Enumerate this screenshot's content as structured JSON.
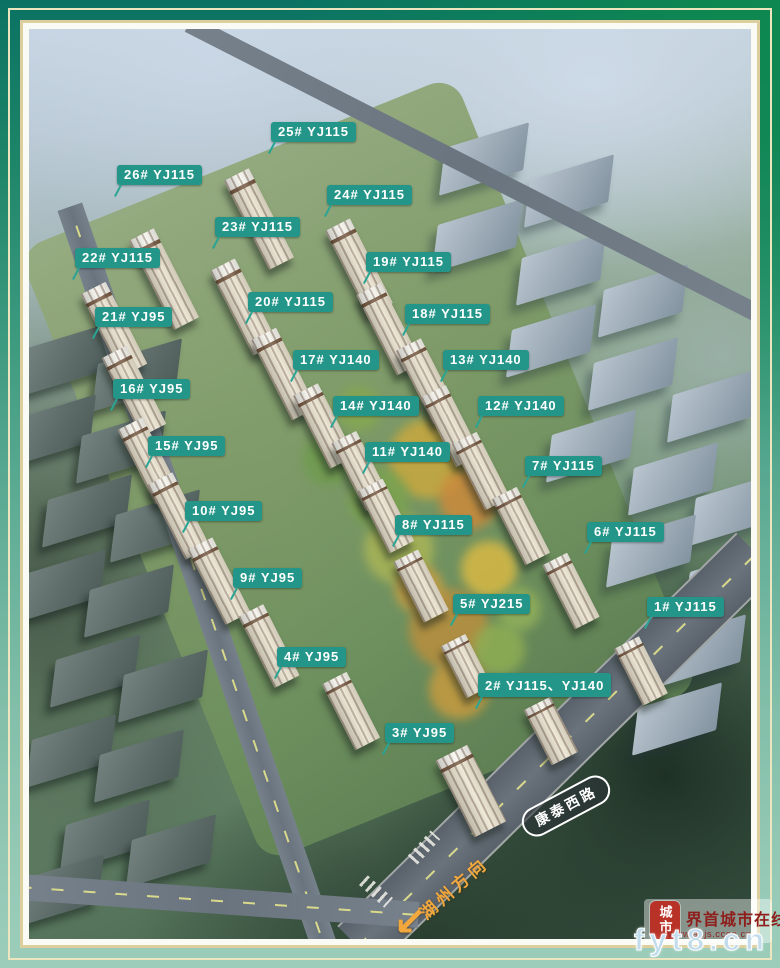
{
  "colors": {
    "label_bg": "#249689",
    "label_text": "#ffffff",
    "frame_teal_dark": "#0b7263",
    "frame_green": "#0e8a4e",
    "frame_teal_light": "#9ccdbb",
    "frame_line_cream": "#ece5bd",
    "direction_orange": "#f2a83c",
    "watermark_red": "#8e1f1c",
    "watermark_blue": "#c2dcec"
  },
  "site_labels": [
    {
      "text": "25# YJ115",
      "x": 242,
      "y": 93
    },
    {
      "text": "26# YJ115",
      "x": 88,
      "y": 136
    },
    {
      "text": "24# YJ115",
      "x": 298,
      "y": 156
    },
    {
      "text": "23# YJ115",
      "x": 186,
      "y": 188
    },
    {
      "text": "22# YJ115",
      "x": 46,
      "y": 219
    },
    {
      "text": "19# YJ115",
      "x": 337,
      "y": 223
    },
    {
      "text": "20# YJ115",
      "x": 219,
      "y": 263
    },
    {
      "text": "21# YJ95",
      "x": 66,
      "y": 278
    },
    {
      "text": "18# YJ115",
      "x": 376,
      "y": 275
    },
    {
      "text": "17# YJ140",
      "x": 264,
      "y": 321
    },
    {
      "text": "13# YJ140",
      "x": 414,
      "y": 321
    },
    {
      "text": "16# YJ95",
      "x": 84,
      "y": 350
    },
    {
      "text": "14# YJ140",
      "x": 304,
      "y": 367
    },
    {
      "text": "12# YJ140",
      "x": 449,
      "y": 367
    },
    {
      "text": "15# YJ95",
      "x": 119,
      "y": 407
    },
    {
      "text": "11# YJ140",
      "x": 336,
      "y": 413
    },
    {
      "text": "7# YJ115",
      "x": 496,
      "y": 427
    },
    {
      "text": "10# YJ95",
      "x": 156,
      "y": 472
    },
    {
      "text": "8# YJ115",
      "x": 366,
      "y": 486
    },
    {
      "text": "6# YJ115",
      "x": 558,
      "y": 493
    },
    {
      "text": "9# YJ95",
      "x": 204,
      "y": 539
    },
    {
      "text": "5# YJ215",
      "x": 424,
      "y": 565
    },
    {
      "text": "1# YJ115",
      "x": 618,
      "y": 568
    },
    {
      "text": "4# YJ95",
      "x": 248,
      "y": 618
    },
    {
      "text": "2# YJ115、YJ140",
      "x": 449,
      "y": 644
    },
    {
      "text": "3# YJ95",
      "x": 356,
      "y": 694
    }
  ],
  "road_sign": {
    "text": "康泰西路"
  },
  "direction_sign": {
    "text": "湖州方向",
    "arrow": "↙"
  },
  "watermark": {
    "seal_text": "城市",
    "site_name": "界首城市在线",
    "small_url": "www.ahjs.ccoo.cn",
    "big_url": "fyt8.cn"
  },
  "scene": {
    "buildings": [
      [
        230,
        190,
        28,
        100
      ],
      [
        135,
        250,
        28,
        100
      ],
      [
        330,
        238,
        28,
        95
      ],
      [
        215,
        278,
        28,
        95
      ],
      [
        85,
        300,
        28,
        92
      ],
      [
        360,
        300,
        28,
        90
      ],
      [
        255,
        345,
        28,
        90
      ],
      [
        105,
        362,
        28,
        88
      ],
      [
        398,
        352,
        28,
        82
      ],
      [
        295,
        397,
        28,
        82
      ],
      [
        422,
        397,
        28,
        78
      ],
      [
        120,
        432,
        28,
        84
      ],
      [
        332,
        442,
        28,
        76
      ],
      [
        452,
        442,
        28,
        74
      ],
      [
        150,
        487,
        28,
        84
      ],
      [
        357,
        487,
        28,
        70
      ],
      [
        492,
        497,
        28,
        74
      ],
      [
        190,
        552,
        28,
        84
      ],
      [
        392,
        557,
        28,
        68
      ],
      [
        542,
        562,
        28,
        72
      ],
      [
        240,
        617,
        28,
        80
      ],
      [
        437,
        637,
        28,
        58
      ],
      [
        612,
        642,
        28,
        64
      ],
      [
        322,
        682,
        28,
        74
      ],
      [
        522,
        702,
        30,
        62
      ],
      [
        442,
        762,
        36,
        86
      ]
    ],
    "warehouses_right": [
      [
        455,
        130
      ],
      [
        540,
        162
      ],
      [
        448,
        207
      ],
      [
        532,
        240
      ],
      [
        614,
        272
      ],
      [
        522,
        312
      ],
      [
        604,
        345
      ],
      [
        683,
        377
      ],
      [
        562,
        417
      ],
      [
        644,
        450
      ],
      [
        706,
        480
      ],
      [
        622,
        522
      ],
      [
        700,
        554
      ],
      [
        672,
        622
      ],
      [
        648,
        690
      ]
    ],
    "warehouses_left": [
      [
        38,
        330
      ],
      [
        108,
        346
      ],
      [
        22,
        402
      ],
      [
        92,
        418
      ],
      [
        58,
        482
      ],
      [
        126,
        497
      ],
      [
        32,
        557
      ],
      [
        100,
        572
      ],
      [
        66,
        642
      ],
      [
        134,
        657
      ],
      [
        42,
        722
      ],
      [
        110,
        737
      ],
      [
        76,
        807
      ],
      [
        142,
        822
      ],
      [
        30,
        862
      ]
    ],
    "garden_spots": [
      [
        400,
        430,
        40,
        "#c9a83f"
      ],
      [
        440,
        470,
        30,
        "#cc8a3c"
      ],
      [
        370,
        520,
        35,
        "#a9b457"
      ],
      [
        460,
        540,
        28,
        "#d9b945"
      ],
      [
        420,
        600,
        40,
        "#b98f3e"
      ],
      [
        470,
        620,
        26,
        "#8fae54"
      ],
      [
        350,
        470,
        30,
        "#7ca34f"
      ],
      [
        390,
        560,
        24,
        "#d0a243"
      ],
      [
        490,
        580,
        22,
        "#91b05a"
      ],
      [
        430,
        660,
        30,
        "#c79b40"
      ],
      [
        300,
        430,
        26,
        "#6f9b4e"
      ],
      [
        330,
        380,
        22,
        "#85a850"
      ]
    ]
  }
}
